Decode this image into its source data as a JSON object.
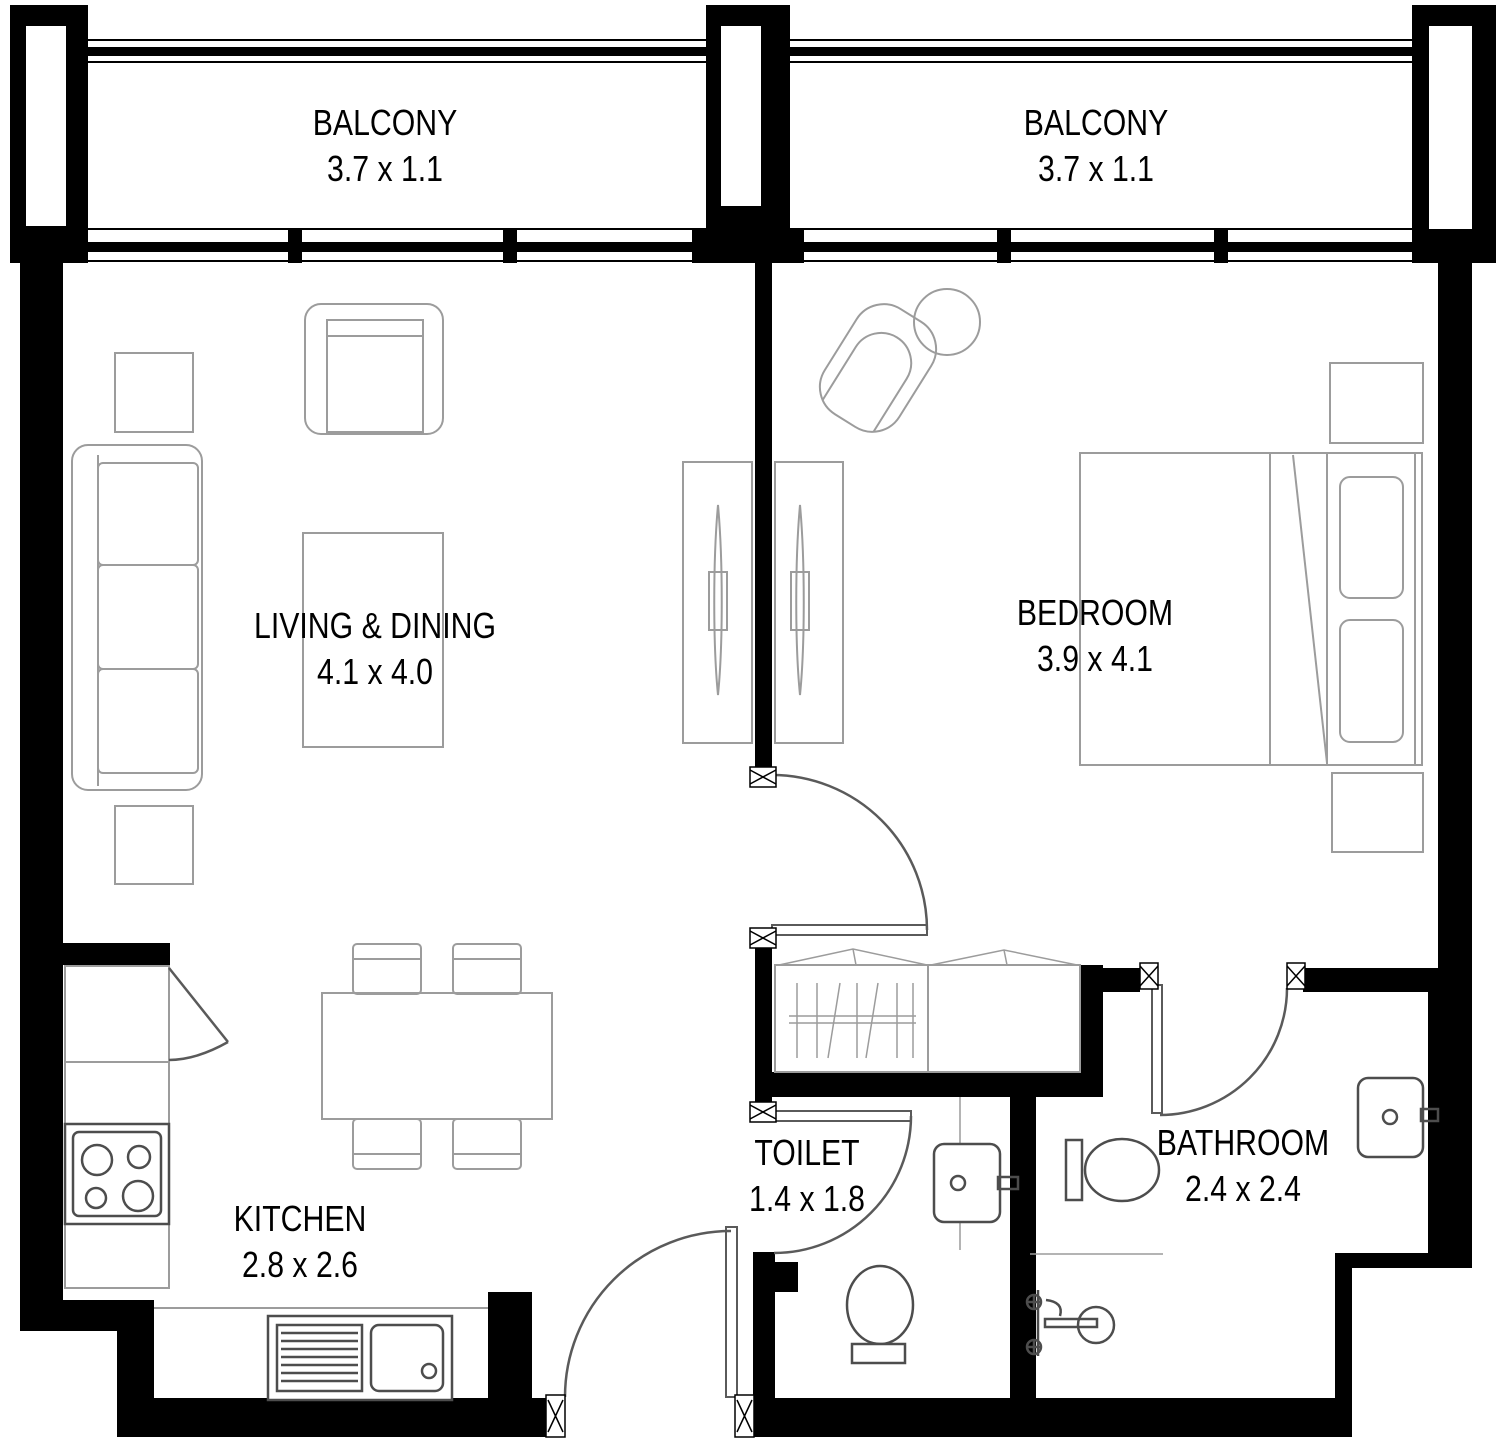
{
  "plan": {
    "type": "apartment-floor-plan",
    "rooms": [
      {
        "id": "balcony-left",
        "label": "BALCONY",
        "dims": "3.7 x 1.1"
      },
      {
        "id": "balcony-right",
        "label": "BALCONY",
        "dims": "3.7 x 1.1"
      },
      {
        "id": "living-dining",
        "label": "LIVING & DINING",
        "dims": "4.1 x 4.0"
      },
      {
        "id": "bedroom",
        "label": "BEDROOM",
        "dims": "3.9 x 4.1"
      },
      {
        "id": "kitchen",
        "label": "KITCHEN",
        "dims": "2.8 x 2.6"
      },
      {
        "id": "toilet",
        "label": "TOILET",
        "dims": "1.4 x 1.8"
      },
      {
        "id": "bathroom",
        "label": "BATHROOM",
        "dims": "2.4 x 2.4"
      }
    ],
    "colors": {
      "wall": "#000000",
      "furniture": "#9c9c9c",
      "fixture": "#4d4d4d",
      "door": "#5a5a5a",
      "text": "#000000",
      "background": "#ffffff"
    }
  }
}
